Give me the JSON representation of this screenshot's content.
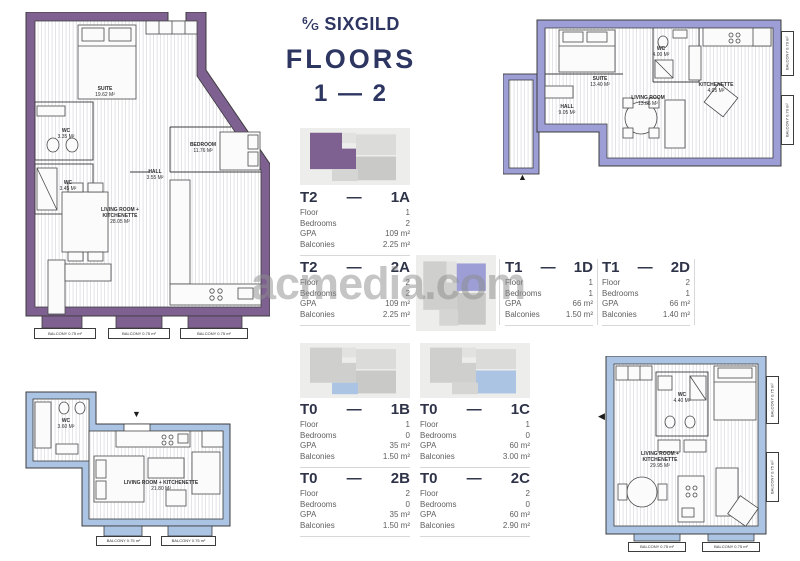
{
  "header": {
    "logo_numerator": "6",
    "logo_slash": "⁄",
    "logo_denominator": "G",
    "brand": "SIXGILD",
    "floors_label": "FLOORS",
    "floors_range": "1 — 2"
  },
  "watermark": "acmedia.com",
  "spec_labels": {
    "floor": "Floor",
    "bedrooms": "Bedrooms",
    "gpa": "GPA",
    "balconies": "Balconies",
    "dash": "—"
  },
  "units": [
    {
      "type": "T2",
      "num": "1A",
      "floor": "1",
      "bedrooms": "2",
      "gpa": "109 m²",
      "balconies": "2.25 m²"
    },
    {
      "type": "T2",
      "num": "2A",
      "floor": "2",
      "bedrooms": "2",
      "gpa": "109 m²",
      "balconies": "2.25 m²"
    },
    {
      "type": "T1",
      "num": "1D",
      "floor": "1",
      "bedrooms": "1",
      "gpa": "66 m²",
      "balconies": "1.50 m²"
    },
    {
      "type": "T1",
      "num": "2D",
      "floor": "2",
      "bedrooms": "1",
      "gpa": "66 m²",
      "balconies": "1.40 m²"
    },
    {
      "type": "T0",
      "num": "1B",
      "floor": "1",
      "bedrooms": "0",
      "gpa": "35 m²",
      "balconies": "1.50 m²"
    },
    {
      "type": "T0",
      "num": "2B",
      "floor": "2",
      "bedrooms": "0",
      "gpa": "35 m²",
      "balconies": "1.50 m²"
    },
    {
      "type": "T0",
      "num": "1C",
      "floor": "1",
      "bedrooms": "0",
      "gpa": "60 m²",
      "balconies": "3.00 m²"
    },
    {
      "type": "T0",
      "num": "2C",
      "floor": "2",
      "bedrooms": "0",
      "gpa": "60 m²",
      "balconies": "2.90 m²"
    }
  ],
  "plans": {
    "t2": {
      "rooms": [
        {
          "name": "SUITE",
          "area": "19.62 m²"
        },
        {
          "name": "WC",
          "area": "3.35 m²"
        },
        {
          "name": "WC",
          "area": "3.45 m²"
        },
        {
          "name": "BEDROOM",
          "area": "11.76 m²"
        },
        {
          "name": "HALL",
          "area": "3.55 m²"
        },
        {
          "name": "LIVING ROOM + KITCHENETTE",
          "area": "28.05 m²"
        }
      ],
      "balconies": [
        "BALCONY 0.75 m²",
        "BALCONY 0.75 m²",
        "BALCONY 0.75 m²"
      ]
    },
    "t1": {
      "rooms": [
        {
          "name": "SUITE",
          "area": "13.40 m²"
        },
        {
          "name": "WC",
          "area": "4.00 m²"
        },
        {
          "name": "KITCHENETTE",
          "area": "4.05 m²"
        },
        {
          "name": "LIVING ROOM",
          "area": "13.85 m²"
        },
        {
          "name": "HALL",
          "area": "9.05 m²"
        }
      ],
      "balconies": [
        "BALCONY 0.70 m²",
        "BALCONY 0.70 m²"
      ]
    },
    "t0b": {
      "rooms": [
        {
          "name": "WC",
          "area": "3.60 m²"
        },
        {
          "name": "LIVING ROOM + KITCHENETTE",
          "area": "21.80 m²"
        }
      ],
      "balconies": [
        "BALCONY 0.75 m²",
        "BALCONY 0.75 m²"
      ]
    },
    "t0c": {
      "rooms": [
        {
          "name": "WC",
          "area": "4.40 m²"
        },
        {
          "name": "LIVING ROOM + KITCHENETTE",
          "area": "29.95 m²"
        }
      ],
      "balconies": [
        "BALCONY 0.75 m²",
        "BALCONY 0.75 m²",
        "BALCONY 0.75 m²",
        "BALCONY 0.75 m²"
      ]
    }
  },
  "icons": {
    "arrow_up": "▲",
    "arrow_down": "▼",
    "arrow_left": "◀"
  },
  "colors": {
    "t2_purple": "#7e6191",
    "t1_periwinkle": "#9d9ed6",
    "t0_blue": "#abc4e3",
    "navy": "#2d3561",
    "plan_grey": "#d6d6d4"
  }
}
